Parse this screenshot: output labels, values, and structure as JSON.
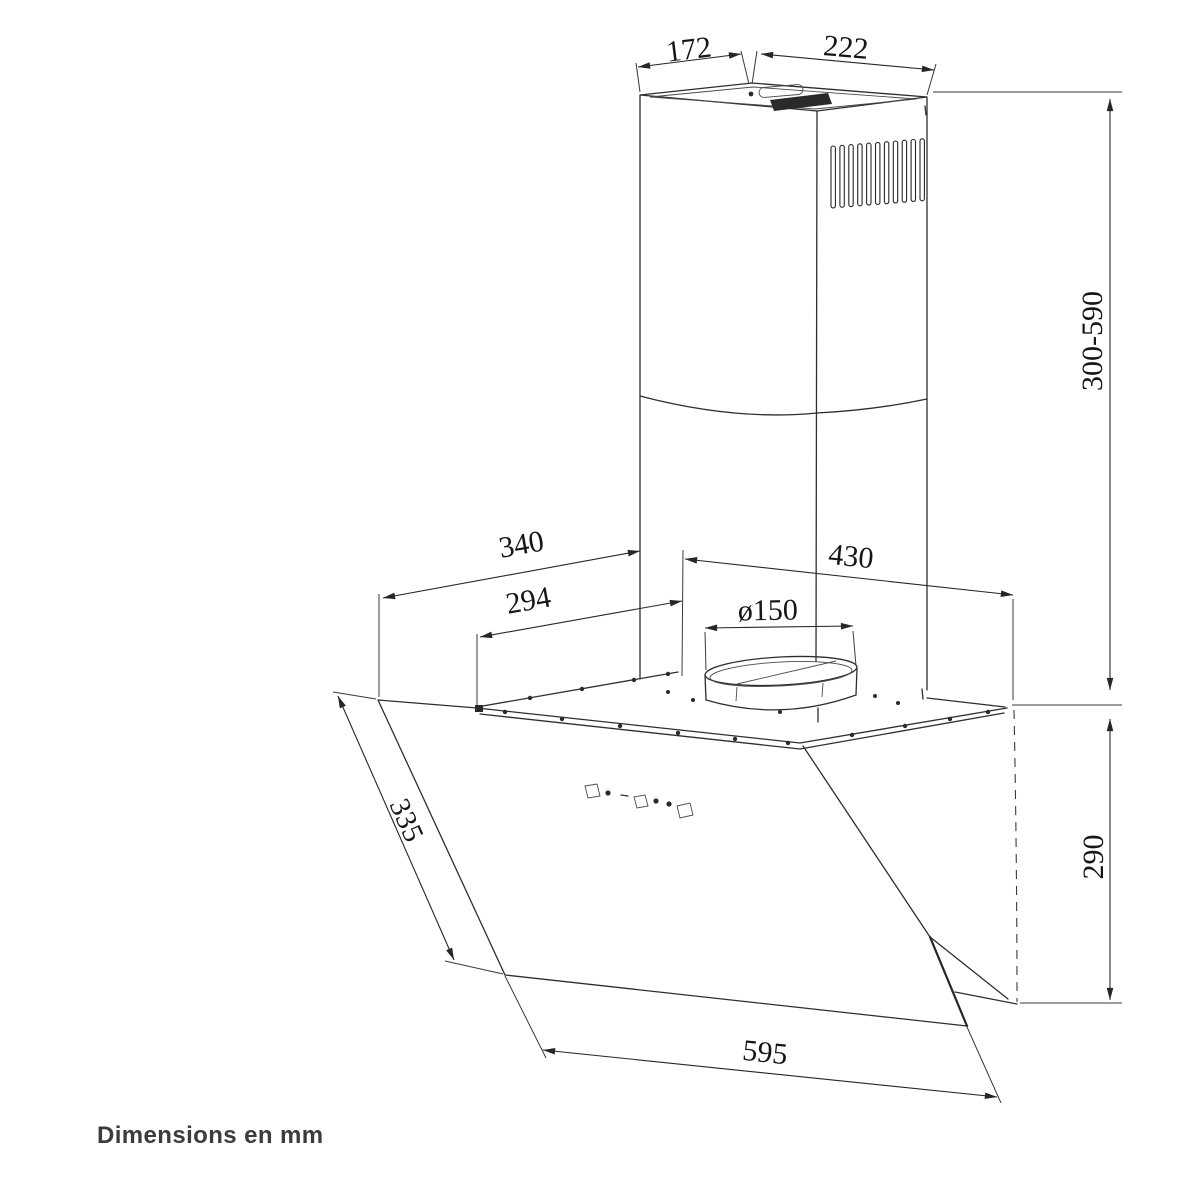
{
  "drawing": {
    "footer": "Dimensions en mm",
    "dims": {
      "chimney_top_depth": "172",
      "chimney_top_width": "222",
      "chimney_height_range": "300-590",
      "hood_left_offset": "340",
      "hood_top_left_edge": "294",
      "hood_top_width": "430",
      "duct_diameter": "ø150",
      "glass_slant_depth": "335",
      "body_height": "290",
      "glass_width": "595"
    },
    "colors": {
      "line": "#2e2e2e",
      "text": "#161616",
      "footer_text": "#3c3c3c",
      "background": "#ffffff"
    }
  }
}
